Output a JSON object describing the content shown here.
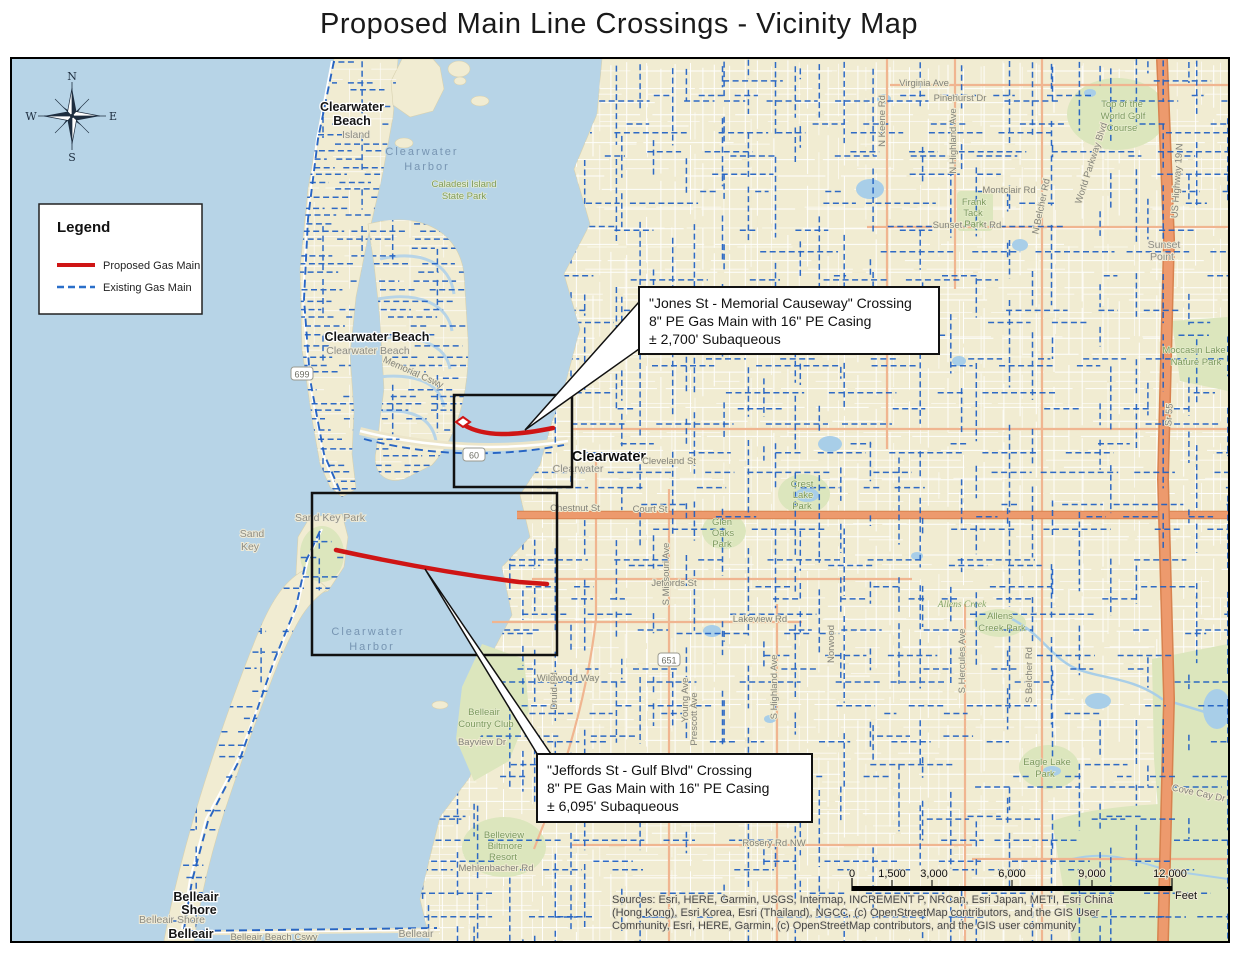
{
  "title": "Proposed Main Line Crossings - Vicinity Map",
  "legend": {
    "title": "Legend",
    "items": [
      {
        "label": "Proposed Gas Main",
        "color": "#cf1515",
        "style": "solid"
      },
      {
        "label": "Existing Gas Main",
        "color": "#2a6fc9",
        "style": "dashed"
      }
    ]
  },
  "compass": {
    "n": "N",
    "s": "S",
    "e": "E",
    "w": "W"
  },
  "callouts": [
    {
      "id": "jones-crossing",
      "lines": [
        "\"Jones St - Memorial Causeway\" Crossing",
        "8\" PE Gas Main with 16\" PE Casing",
        "± 2,700' Subaqueous"
      ]
    },
    {
      "id": "jeffords-crossing",
      "lines": [
        "\"Jeffords St - Gulf Blvd\" Crossing",
        "8\" PE Gas Main with 16\" PE Casing",
        "± 6,095' Subaqueous"
      ]
    }
  ],
  "scale_bar": {
    "ticks": [
      "0",
      "1,500",
      "3,000",
      "6,000",
      "9,000",
      "12,000"
    ],
    "unit": "Feet"
  },
  "attribution": [
    "Sources: Esri, HERE, Garmin, USGS, Intermap, INCREMENT P, NRCan, Esri Japan, METI, Esri China",
    "(Hong Kong), Esri Korea, Esri (Thailand), NGCC, (c) OpenStreetMap contributors, and the GIS User",
    "Community, Esri, HERE, Garmin, (c) OpenStreetMap contributors, and the GIS user community"
  ],
  "route_shields": [
    {
      "label": "699",
      "x": 290,
      "y": 316
    },
    {
      "label": "60",
      "x": 462,
      "y": 397
    },
    {
      "label": "651",
      "x": 657,
      "y": 602
    }
  ],
  "colors": {
    "water": "#b7d4e7",
    "land": "#f1ecd2",
    "park": "#dce6bd",
    "existing_main": "#1d5ec2",
    "proposed_main": "#cf1515",
    "major_road": "#ea9366",
    "minor_road": "#ffffff"
  },
  "map_labels": [
    {
      "text": "Clearwater",
      "x": 410,
      "y": 96,
      "cls": "water"
    },
    {
      "text": "Harbor",
      "x": 415,
      "y": 111,
      "cls": "water"
    },
    {
      "text": "Caladesi Island",
      "x": 452,
      "y": 128,
      "cls": "park"
    },
    {
      "text": "State Park",
      "x": 452,
      "y": 140,
      "cls": "park"
    },
    {
      "text": "Clearwater",
      "x": 340,
      "y": 52,
      "cls": "city"
    },
    {
      "text": "Beach",
      "x": 340,
      "y": 66,
      "cls": "city"
    },
    {
      "text": "Island",
      "x": 344,
      "y": 79,
      "cls": "place"
    },
    {
      "text": "Clearwater Beach",
      "x": 365,
      "y": 282,
      "cls": "city"
    },
    {
      "text": "Clearwater Beach",
      "x": 356,
      "y": 295,
      "cls": "place"
    },
    {
      "text": "Memorial Cswy",
      "x": 400,
      "y": 316,
      "cls": "street",
      "rot": 24
    },
    {
      "text": "Clearwater",
      "x": 597,
      "y": 402,
      "cls": "city-lg"
    },
    {
      "text": "Clearwater",
      "x": 566,
      "y": 413,
      "cls": "place"
    },
    {
      "text": "Sand Key Park",
      "x": 318,
      "y": 462,
      "cls": "place"
    },
    {
      "text": "Sand",
      "x": 240,
      "y": 478,
      "cls": "place"
    },
    {
      "text": "Key",
      "x": 238,
      "y": 491,
      "cls": "place"
    },
    {
      "text": "Clearwater",
      "x": 356,
      "y": 576,
      "cls": "water"
    },
    {
      "text": "Harbor",
      "x": 360,
      "y": 591,
      "cls": "water"
    },
    {
      "text": "Belleair",
      "x": 472,
      "y": 656,
      "cls": "park"
    },
    {
      "text": "Country Club",
      "x": 474,
      "y": 668,
      "cls": "park"
    },
    {
      "text": "Belleview",
      "x": 492,
      "y": 779,
      "cls": "park"
    },
    {
      "text": "Biltmore",
      "x": 493,
      "y": 790,
      "cls": "park"
    },
    {
      "text": "Resort",
      "x": 491,
      "y": 801,
      "cls": "park"
    },
    {
      "text": "Mehlenbacher Rd",
      "x": 484,
      "y": 812,
      "cls": "street"
    },
    {
      "text": "Belleair",
      "x": 184,
      "y": 842,
      "cls": "city"
    },
    {
      "text": "Shore",
      "x": 187,
      "y": 855,
      "cls": "city"
    },
    {
      "text": "Belleair Shore",
      "x": 160,
      "y": 864,
      "cls": "place"
    },
    {
      "text": "Belleair",
      "x": 179,
      "y": 879,
      "cls": "city"
    },
    {
      "text": "Belleair Beach Cswy",
      "x": 262,
      "y": 881,
      "cls": "street"
    },
    {
      "text": "Belleair",
      "x": 404,
      "y": 878,
      "cls": "place"
    },
    {
      "text": "Chestnut St",
      "x": 563,
      "y": 452,
      "cls": "street"
    },
    {
      "text": "Court St",
      "x": 638,
      "y": 453,
      "cls": "street"
    },
    {
      "text": "Cleveland St",
      "x": 657,
      "y": 405,
      "cls": "street"
    },
    {
      "text": "Jeffords St",
      "x": 662,
      "y": 527,
      "cls": "street"
    },
    {
      "text": "Lakeview Rd",
      "x": 748,
      "y": 563,
      "cls": "street"
    },
    {
      "text": "Druid Rd",
      "x": 545,
      "y": 632,
      "cls": "street",
      "rot": -90
    },
    {
      "text": "S Missouri Ave",
      "x": 657,
      "y": 515,
      "cls": "street",
      "rot": -90
    },
    {
      "text": "Young Ave",
      "x": 676,
      "y": 641,
      "cls": "street",
      "rot": -90
    },
    {
      "text": "Prescott Ave",
      "x": 685,
      "y": 660,
      "cls": "street",
      "rot": -90
    },
    {
      "text": "S Highland Ave",
      "x": 765,
      "y": 628,
      "cls": "street",
      "rot": -90
    },
    {
      "text": "Norwood",
      "x": 822,
      "y": 585,
      "cls": "street",
      "rot": -90
    },
    {
      "text": "S Hercules Ave",
      "x": 953,
      "y": 602,
      "cls": "street",
      "rot": -90
    },
    {
      "text": "S Belcher Rd",
      "x": 1020,
      "y": 616,
      "cls": "street",
      "rot": -90
    },
    {
      "text": "N Keene Rd",
      "x": 873,
      "y": 62,
      "cls": "street",
      "rot": -90
    },
    {
      "text": "Virginia Ave",
      "x": 912,
      "y": 27,
      "cls": "street"
    },
    {
      "text": "Pinehurst Dr",
      "x": 948,
      "y": 42,
      "cls": "street"
    },
    {
      "text": "N Highland Ave",
      "x": 944,
      "y": 82,
      "cls": "street",
      "rot": -90
    },
    {
      "text": "Montclair Rd",
      "x": 997,
      "y": 134,
      "cls": "street"
    },
    {
      "text": "Sunset Point Rd",
      "x": 955,
      "y": 169,
      "cls": "street"
    },
    {
      "text": "N Belcher Rd",
      "x": 1032,
      "y": 148,
      "cls": "street",
      "rot": -78
    },
    {
      "text": "World Parkway Blvd",
      "x": 1082,
      "y": 105,
      "cls": "street",
      "rot": -72
    },
    {
      "text": "Top of the",
      "x": 1110,
      "y": 48,
      "cls": "park"
    },
    {
      "text": "World Golf",
      "x": 1111,
      "y": 60,
      "cls": "park"
    },
    {
      "text": "Course",
      "x": 1110,
      "y": 72,
      "cls": "park"
    },
    {
      "text": "Frank",
      "x": 962,
      "y": 146,
      "cls": "park"
    },
    {
      "text": "Tack",
      "x": 961,
      "y": 157,
      "cls": "park"
    },
    {
      "text": "Park",
      "x": 962,
      "y": 168,
      "cls": "park"
    },
    {
      "text": "US Highway 19 N",
      "x": 1168,
      "y": 122,
      "cls": "street",
      "rot": -86
    },
    {
      "text": "Sunset",
      "x": 1152,
      "y": 189,
      "cls": "place"
    },
    {
      "text": "Point",
      "x": 1150,
      "y": 201,
      "cls": "place"
    },
    {
      "text": "Moccasin Lake",
      "x": 1182,
      "y": 294,
      "cls": "park"
    },
    {
      "text": "Nature Park",
      "x": 1184,
      "y": 306,
      "cls": "park"
    },
    {
      "text": "Sr 55",
      "x": 1160,
      "y": 356,
      "cls": "street",
      "rot": -86
    },
    {
      "text": "Glen",
      "x": 710,
      "y": 466,
      "cls": "park"
    },
    {
      "text": "Oaks",
      "x": 711,
      "y": 477,
      "cls": "park"
    },
    {
      "text": "Park",
      "x": 710,
      "y": 488,
      "cls": "park"
    },
    {
      "text": "Crest",
      "x": 790,
      "y": 428,
      "cls": "park"
    },
    {
      "text": "Lake",
      "x": 791,
      "y": 439,
      "cls": "park"
    },
    {
      "text": "Park",
      "x": 790,
      "y": 450,
      "cls": "park"
    },
    {
      "text": "Allens Creek",
      "x": 950,
      "y": 548,
      "cls": "stream"
    },
    {
      "text": "Allens",
      "x": 988,
      "y": 560,
      "cls": "park"
    },
    {
      "text": "Creek Park",
      "x": 990,
      "y": 572,
      "cls": "park"
    },
    {
      "text": "Eagle Lake",
      "x": 1035,
      "y": 706,
      "cls": "park"
    },
    {
      "text": "Park",
      "x": 1033,
      "y": 718,
      "cls": "park"
    },
    {
      "text": "Cove Cay Dr",
      "x": 1186,
      "y": 737,
      "cls": "street",
      "rot": 12
    },
    {
      "text": "Rosery Rd NW",
      "x": 762,
      "y": 787,
      "cls": "street"
    },
    {
      "text": "Wildwood Way",
      "x": 556,
      "y": 622,
      "cls": "street"
    },
    {
      "text": "Bayview Dr",
      "x": 470,
      "y": 686,
      "cls": "street"
    }
  ]
}
